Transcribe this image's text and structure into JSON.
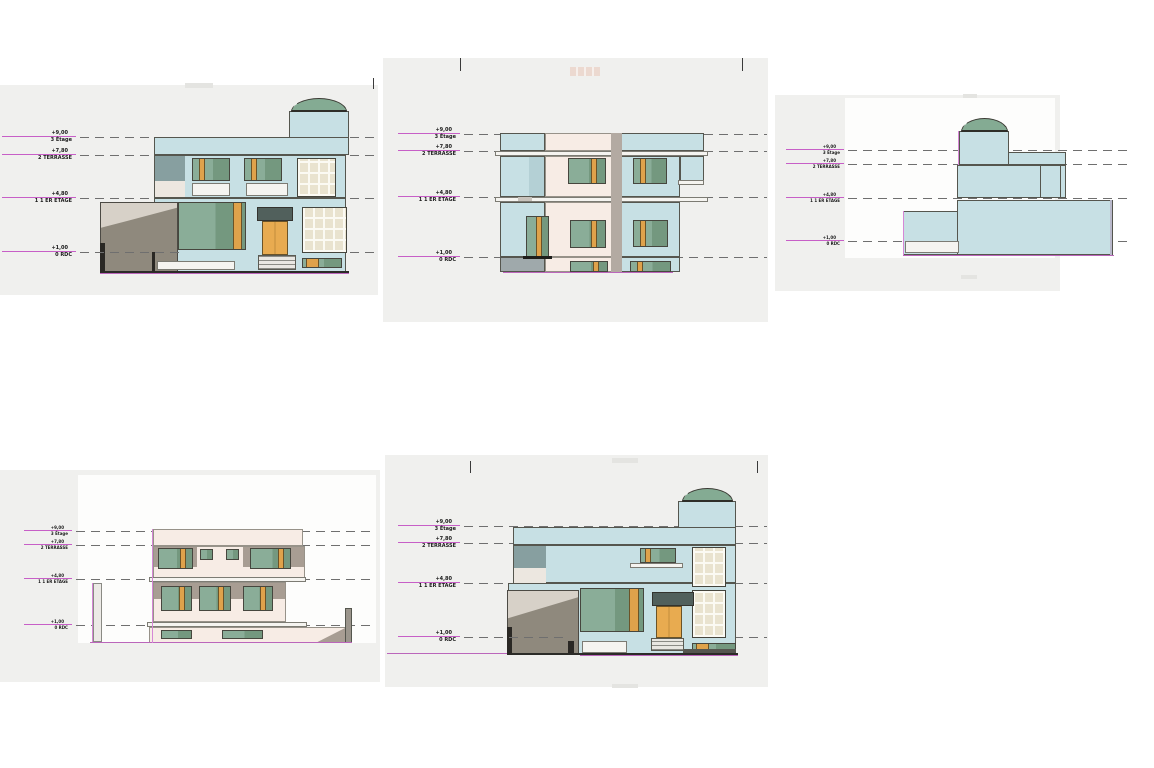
{
  "document": {
    "type": "architectural-elevation-sheet",
    "background": "#ffffff"
  },
  "levels": [
    {
      "value": "+9,00",
      "name": "3 Étage"
    },
    {
      "value": "+7,80",
      "name": "2 TERRASSE"
    },
    {
      "value": "+4,80",
      "name": "1 1 ER ETAGE"
    },
    {
      "value": "+1,00",
      "name": "0 RDC"
    }
  ],
  "drawings": [
    {
      "id": "elevation-front",
      "position": "top-left",
      "style": "blue facade, dome, garage"
    },
    {
      "id": "elevation-rear",
      "position": "top-middle",
      "style": "cream and blue facade"
    },
    {
      "id": "elevation-side-right",
      "position": "top-right",
      "style": "blue side view with dome"
    },
    {
      "id": "elevation-side-left",
      "position": "bottom-left",
      "style": "cream side facade"
    },
    {
      "id": "elevation-front-2",
      "position": "bottom-middle",
      "style": "blue facade, dome, garage"
    }
  ],
  "palette": {
    "backdrop_gray": "#f0f0ee",
    "wall_blue": "#c7e0e4",
    "wall_cream": "#f7ece5",
    "panel_slate": "#879fa0",
    "band_taupe": "#a89d93",
    "garage_dark": "#8f897d",
    "garage_light": "#d7d1c8",
    "dome_green": "#84ab93",
    "glass_green": "#7ea28c",
    "frame_orange": "#dfa24b",
    "door_orange": "#e8ab50",
    "level_line_magenta": "#c75fc7",
    "ground_line_magenta": "#bb66bb",
    "dashed_line_gray": "#6f6f6f"
  }
}
